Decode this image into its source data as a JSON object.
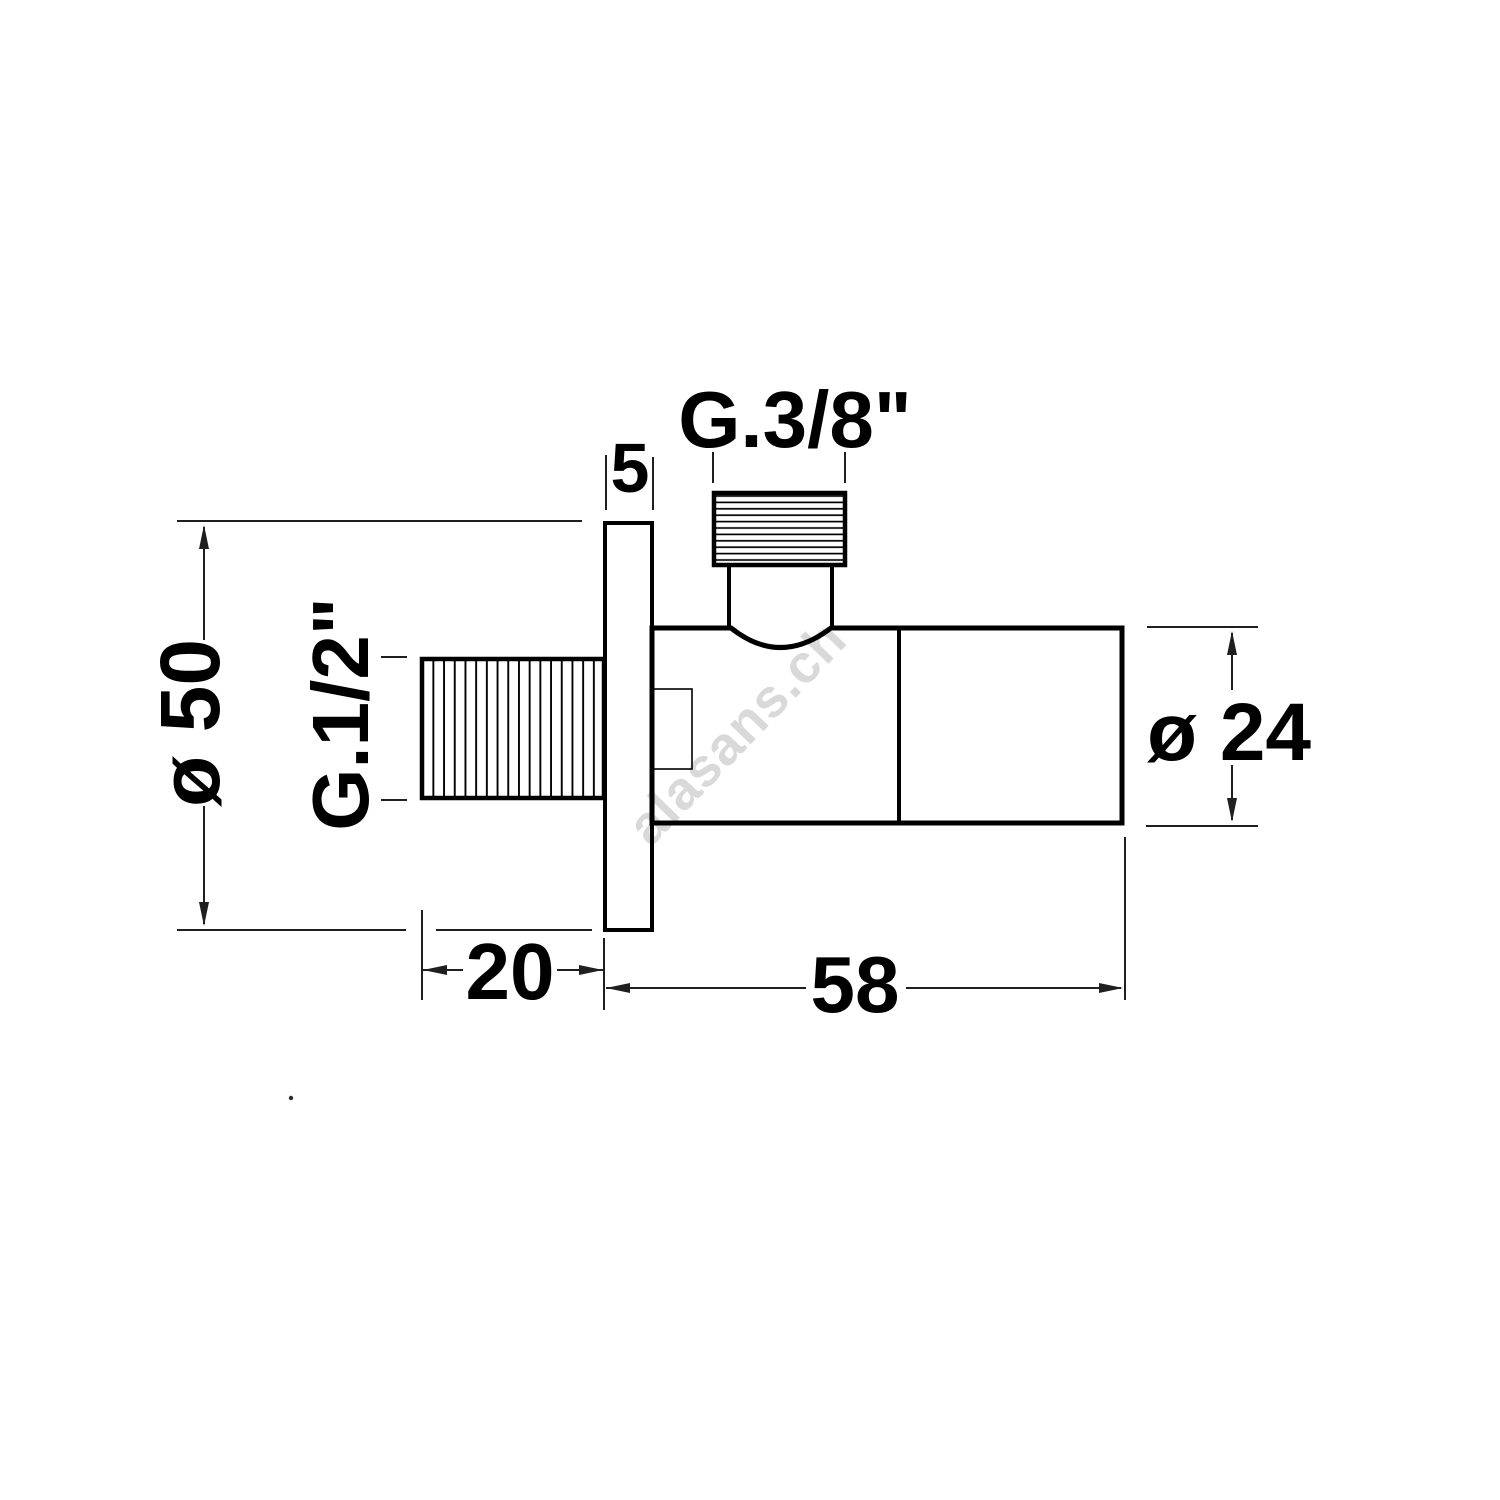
{
  "page": {
    "type": "technical dimension drawing",
    "subject": "angle valve with wall flange, side view",
    "background": "#ffffff"
  },
  "labels": {
    "top_thread": "G.3/8\"",
    "flange_thickness": "5",
    "side_thread": "G.1/2\"",
    "flange_diameter": "ø 50",
    "body_diameter": "ø 24",
    "thread_length": "20",
    "body_length": "58"
  },
  "watermark": {
    "text": "alasans.ch",
    "color": "#d9d9d9"
  },
  "colors": {
    "outline": "#000000",
    "dimension_lines": "#1f1f1f",
    "background": "#ffffff"
  }
}
